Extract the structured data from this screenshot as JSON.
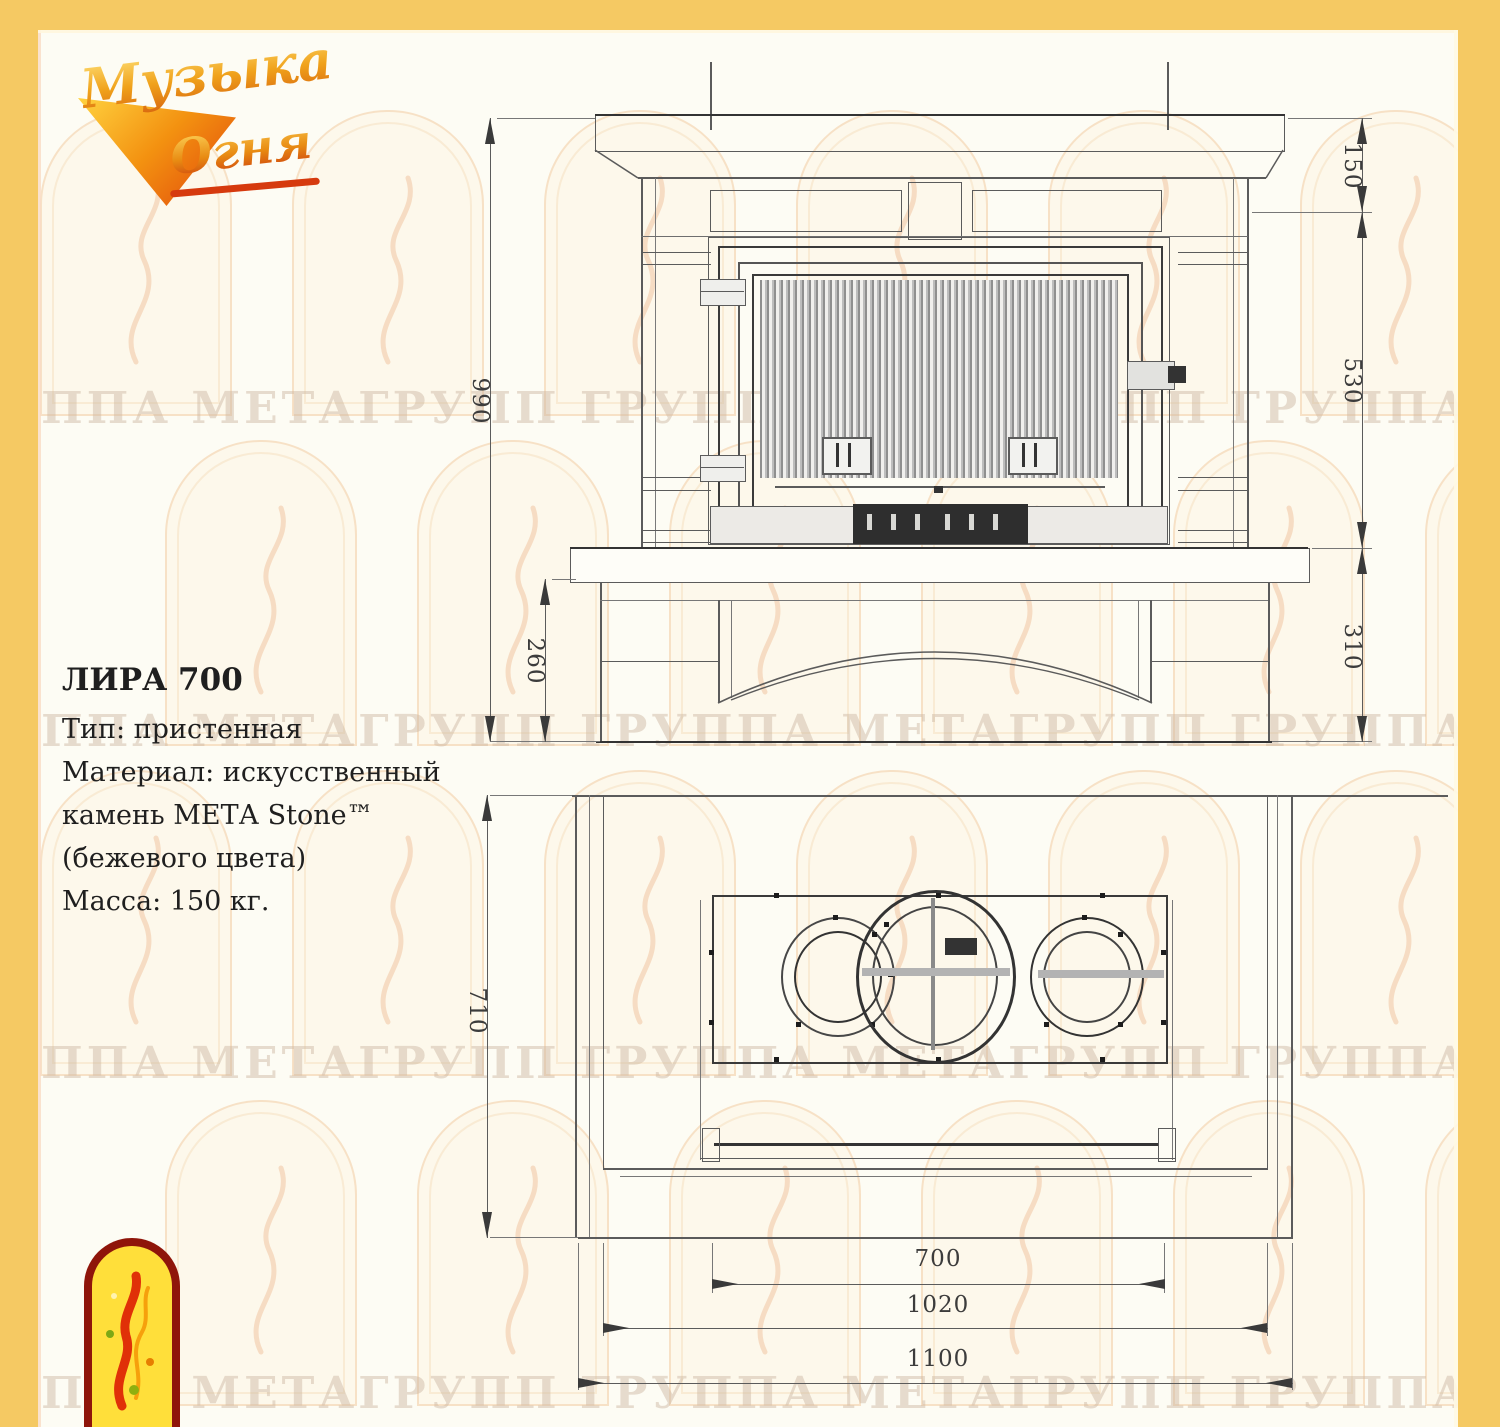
{
  "page": {
    "border_color": "#F5C963",
    "background": "#FDFCF4"
  },
  "brand_logo": {
    "word1": "Музыка",
    "word2": "Огня"
  },
  "watermark": {
    "text": "ГРУППА МЕТАГРУПП"
  },
  "product": {
    "title": "ЛИРА 700",
    "specs": [
      "Тип: пристенная",
      "Материал: искусственный",
      "камень МЕТА Stone™",
      "(бежевого цвета)",
      "Масса: 150 кг."
    ]
  },
  "front_view": {
    "dimensions": {
      "total_height": "990",
      "base_height": "260",
      "top_band": "150",
      "firebox_height": "530",
      "hearth_to_floor": "310"
    }
  },
  "plan_view": {
    "dimensions": {
      "depth": "710",
      "firebox_width": "700",
      "body_width": "1020",
      "total_width": "1100"
    }
  }
}
